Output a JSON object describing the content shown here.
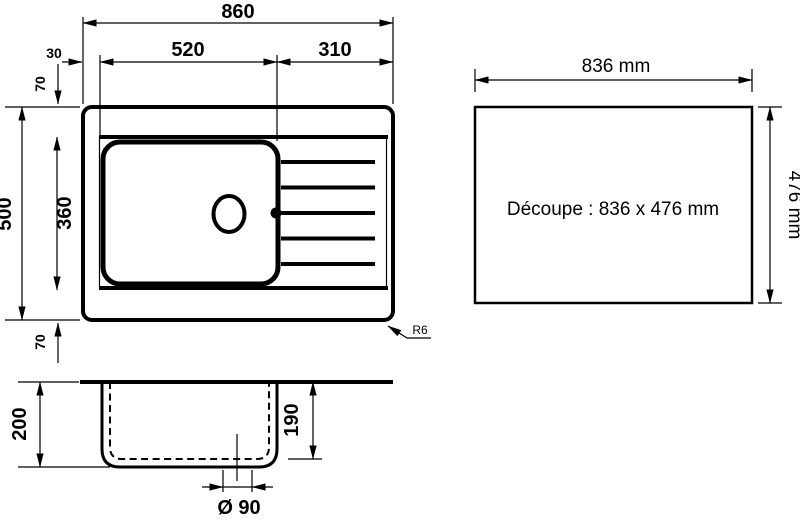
{
  "plan_view": {
    "dim_overall_width": "860",
    "dim_bowl_zone_width": "520",
    "dim_drainer_zone_width": "310",
    "dim_edge_offset_left": "30",
    "dim_edge_offset_top": "70",
    "dim_overall_depth": "500",
    "dim_bowl_depth": "360",
    "dim_edge_offset_bottom": "70",
    "corner_radius": "R6"
  },
  "cutout_view": {
    "dim_width": "836 mm",
    "dim_height": "476 mm",
    "label": "Découpe : 836 x 476 mm"
  },
  "section_view": {
    "dim_total_depth": "200",
    "dim_bowl_inner_depth": "190",
    "dim_drain_diameter": "Ø 90"
  },
  "colors": {
    "line": "#000000",
    "background": "#ffffff"
  }
}
